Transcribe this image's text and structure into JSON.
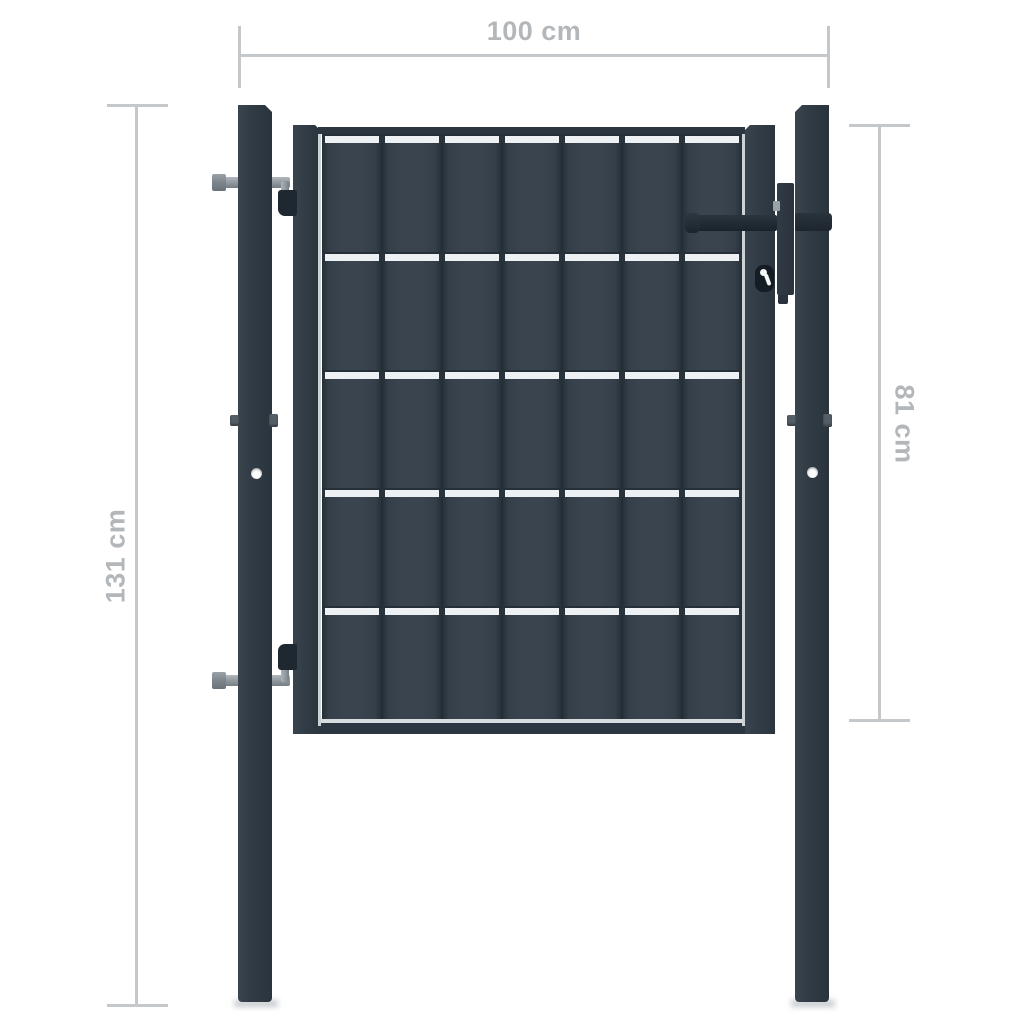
{
  "dimensions": {
    "width_label": "100 cm",
    "post_height_label": "131 cm",
    "gate_height_label": "81 cm"
  },
  "colors": {
    "background": "#ffffff",
    "anthracite": "#333d47",
    "anthracite_dark": "#2a343d",
    "anthracite_deep": "#1f2830",
    "metal_gray": "#9aa1a7",
    "mesh_light": "#eef1f3",
    "wire_gray": "#cdd2d5",
    "dimension_line": "#c5c8cb",
    "dimension_text": "#b3b7ba"
  }
}
